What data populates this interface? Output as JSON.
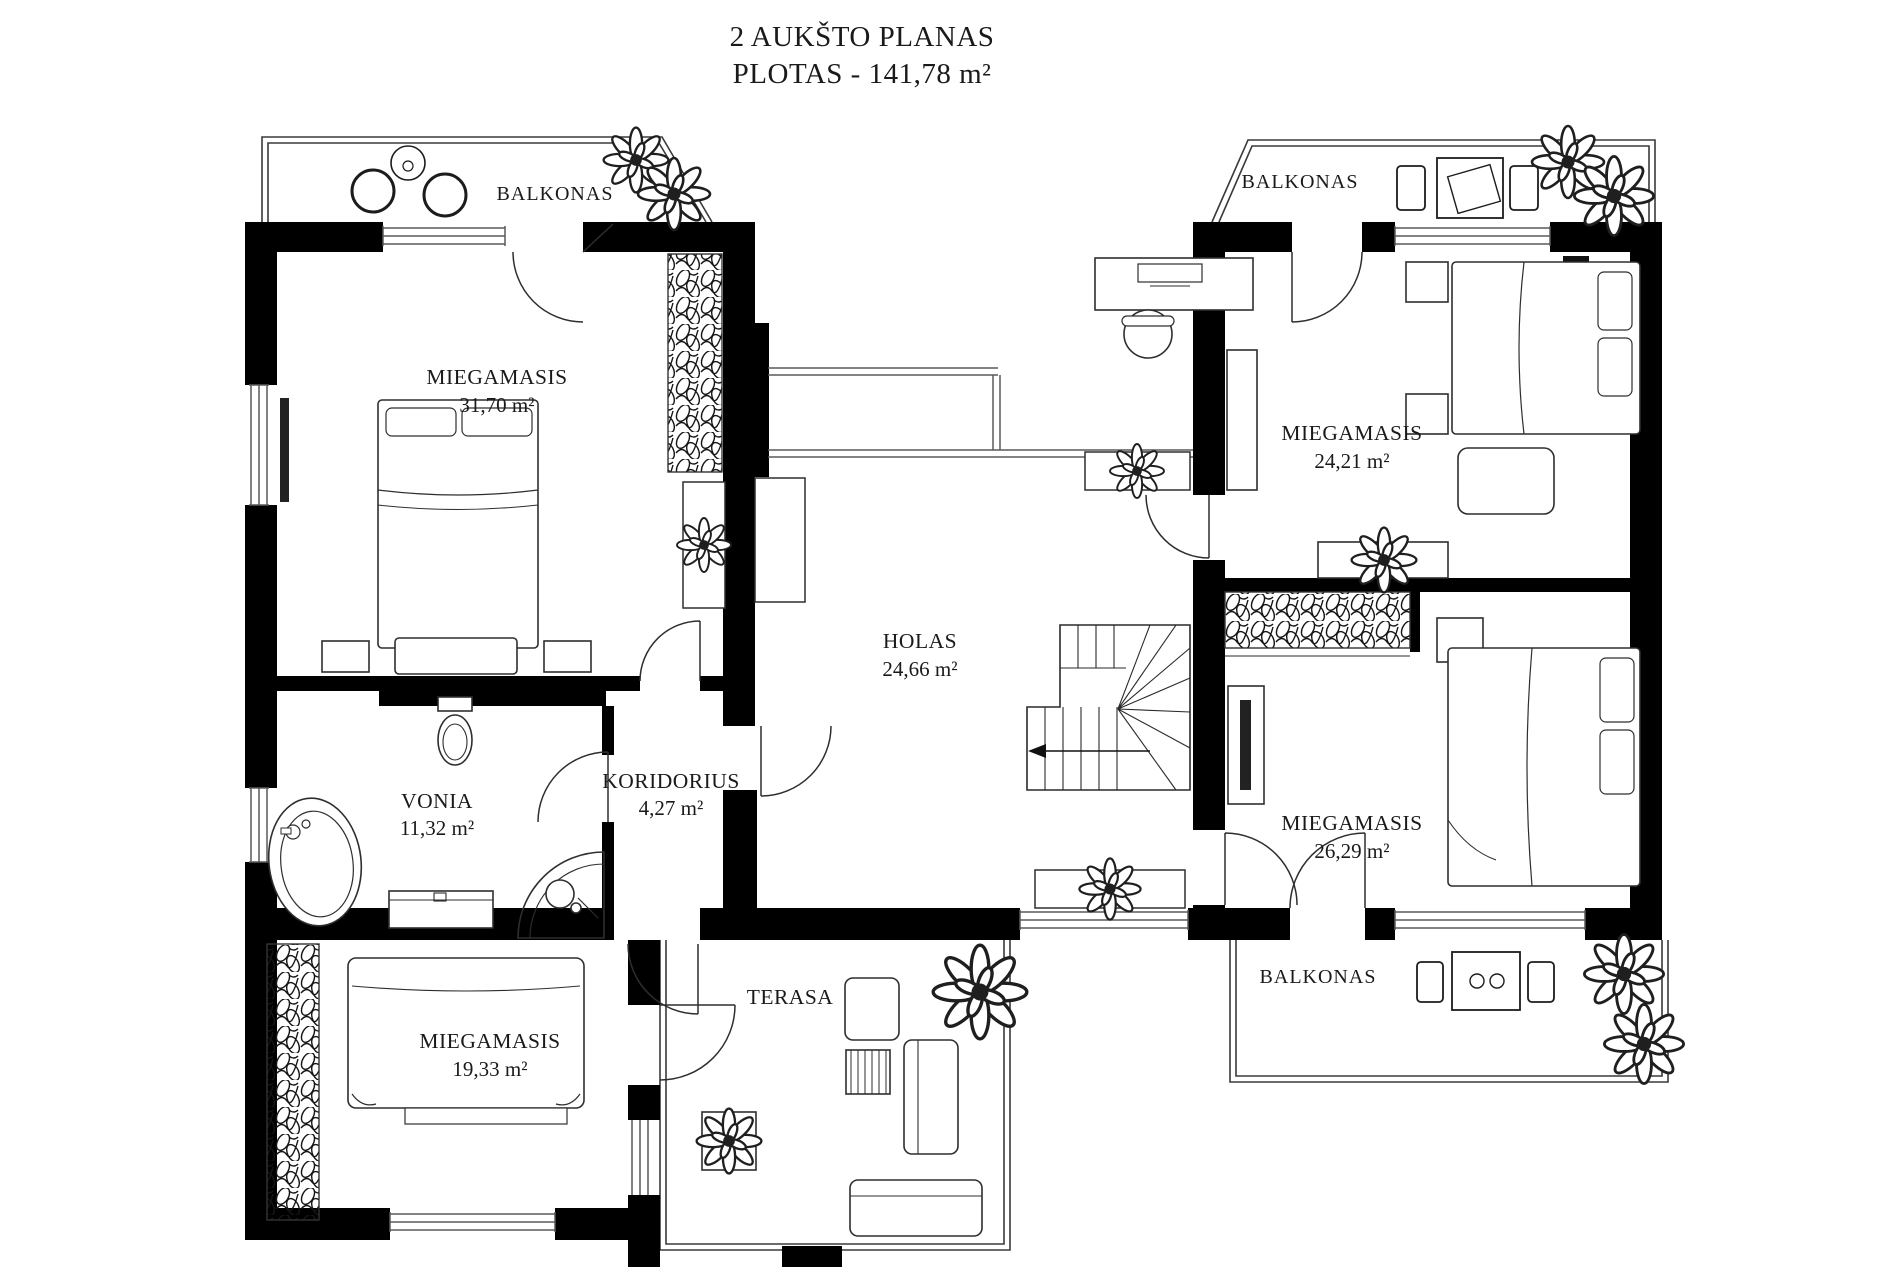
{
  "title": {
    "line1": "2 AUKŠTO PLANAS",
    "line2": "PLOTAS - 141,78 m²"
  },
  "rooms": {
    "bedroom1": {
      "name": "MIEGAMASIS",
      "area": "31,70 m²"
    },
    "bedroom2": {
      "name": "MIEGAMASIS",
      "area": "24,21 m²"
    },
    "bedroom3": {
      "name": "MIEGAMASIS",
      "area": "26,29 m²"
    },
    "bedroom4": {
      "name": "MIEGAMASIS",
      "area": "19,33 m²"
    },
    "hall": {
      "name": "HOLAS",
      "area": "24,66 m²"
    },
    "corridor": {
      "name": "KORIDORIUS",
      "area": "4,27 m²"
    },
    "bath": {
      "name": "VONIA",
      "area": "11,32 m²"
    },
    "terrace": {
      "name": "TERASA"
    },
    "balcony1": {
      "name": "BALKONAS"
    },
    "balcony2": {
      "name": "BALKONAS"
    },
    "balcony3": {
      "name": "BALKONAS"
    }
  },
  "colors": {
    "wall": "#000000",
    "line": "#2b2b2b",
    "thin": "#6a6a6a",
    "text": "#1a1a1a",
    "background": "#ffffff"
  }
}
